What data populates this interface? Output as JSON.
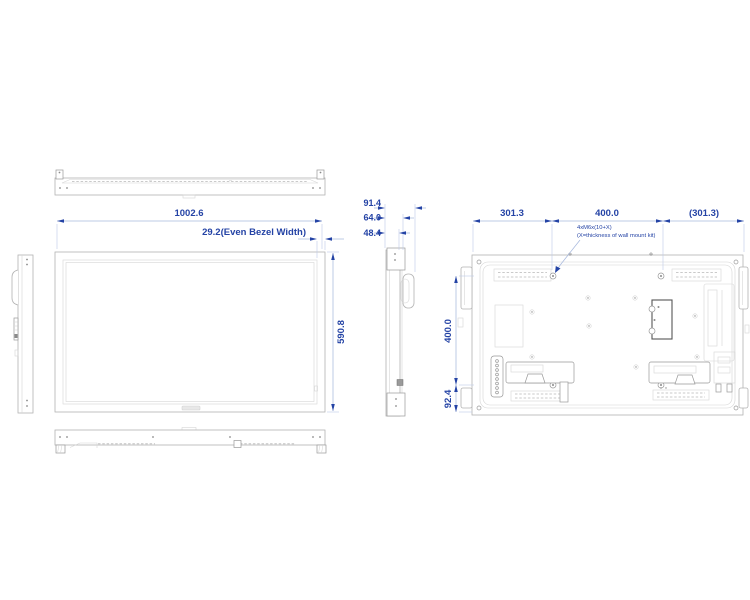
{
  "drawing": {
    "title": "display-dimensional-drawing",
    "front_view": {
      "width_label": "1002.6",
      "bezel_label": "29.2(Even Bezel Width)",
      "height_label": "590.8"
    },
    "side_view": {
      "depth_total_label": "91.4",
      "depth_mount_label": "64.0",
      "depth_body_label": "48.4"
    },
    "rear_view": {
      "left_offset_label": "301.3",
      "vesa_width_label": "400.0",
      "right_offset_label": "(301.3)",
      "vesa_height_label": "400.0",
      "bottom_offset_label": "92.4",
      "mount_note_line1": "4xM6x(10+X)",
      "mount_note_line2": "(X=thickness of wall mount kit)"
    },
    "colors": {
      "dimension_blue": "#2443a5",
      "drawing_gray": "#b3b3b3"
    }
  }
}
